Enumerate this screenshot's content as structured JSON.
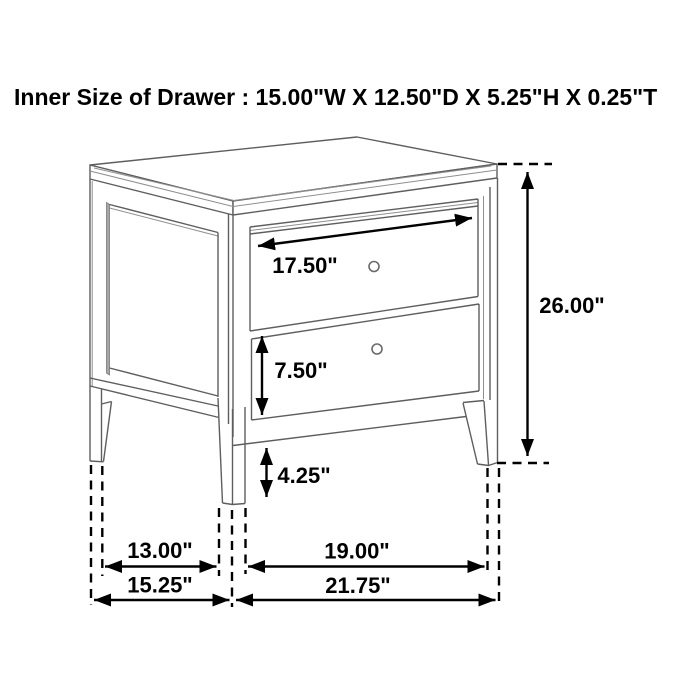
{
  "title": "Inner Size of Drawer : 15.00\"W X 12.50\"D X 5.25\"H X 0.25\"T",
  "dimensions": {
    "drawer_face_width": "17.50\"",
    "bottom_drawer_height": "7.50\"",
    "leg_clearance_height": "4.25\"",
    "overall_height": "26.00\"",
    "inner_leg_depth": "13.00\"",
    "inner_leg_width": "19.00\"",
    "overall_depth": "15.25\"",
    "overall_width": "21.75\""
  }
}
